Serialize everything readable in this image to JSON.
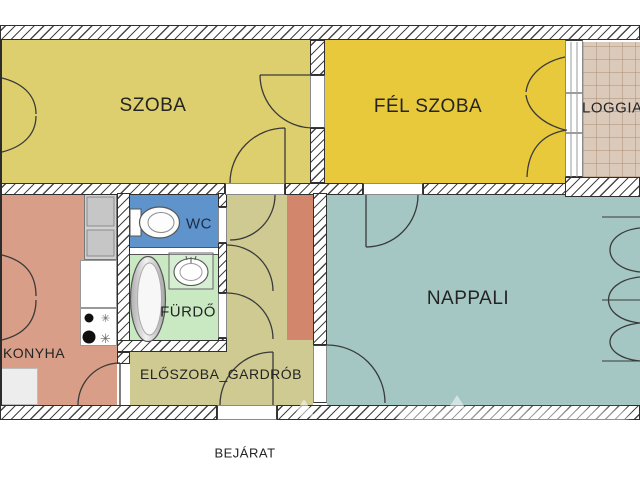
{
  "plan": {
    "rooms": [
      {
        "id": "szoba",
        "label": "SZOBA",
        "color": "#ddcf6d"
      },
      {
        "id": "fel-szoba",
        "label": "FÉL SZOBA",
        "color": "#e8c93c"
      },
      {
        "id": "loggia",
        "label": "LOGGIA",
        "color": "#dbc9b9"
      },
      {
        "id": "konyha",
        "label": "KONYHA",
        "color": "#d89e88"
      },
      {
        "id": "wc",
        "label": "WC",
        "color": "#5f93cb"
      },
      {
        "id": "furdo",
        "label": "FÜRDŐ",
        "color": "#c9e9c2"
      },
      {
        "id": "eloszoba",
        "label": "ELŐSZOBA_GARDRÓB",
        "color": "#cfc992"
      },
      {
        "id": "nappali",
        "label": "NAPPALI",
        "color": "#a4c7c4"
      }
    ],
    "entrance_label": "BEJÁRAT",
    "furniture": {
      "wardrobe_color": "#d2876c"
    },
    "fixtures": {
      "burner_glyph": "✳"
    }
  }
}
